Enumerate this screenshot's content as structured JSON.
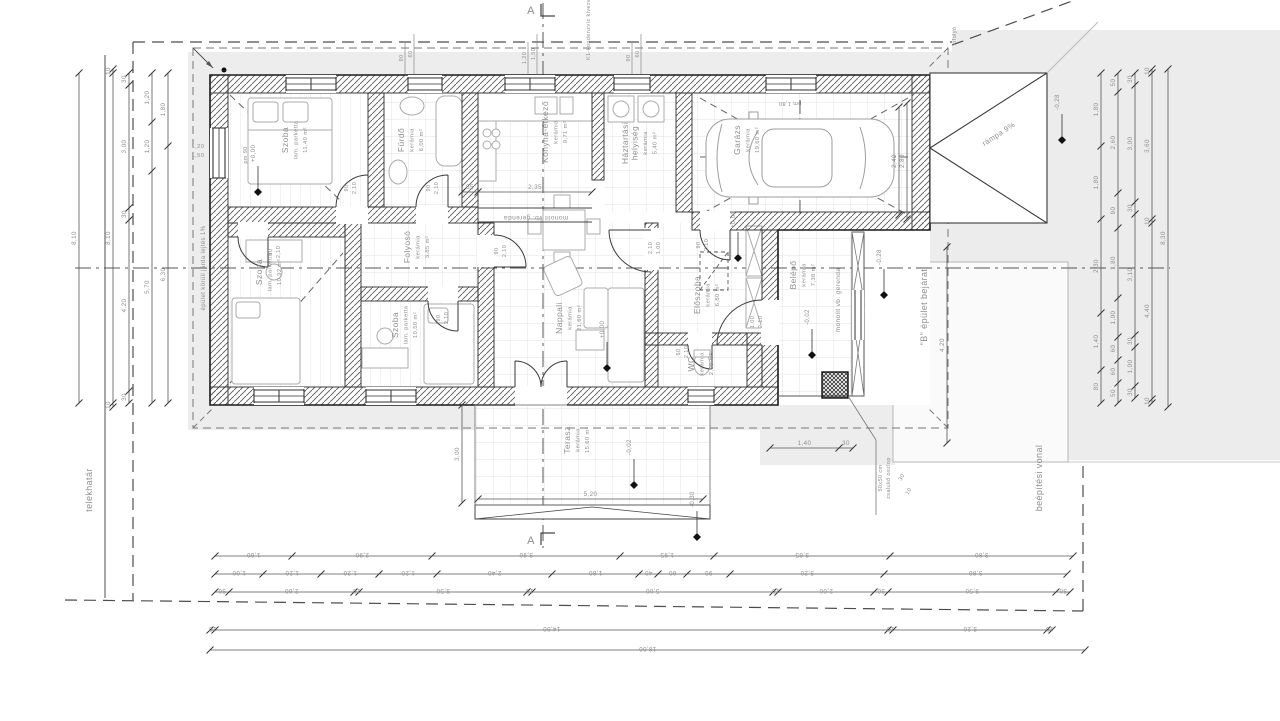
{
  "rooms": [
    {
      "name": "Szoba",
      "finish": "lam. parketta",
      "area": "11,40 m²"
    },
    {
      "name": "Fürdő",
      "finish": "kerámia",
      "area": "6,00 m²"
    },
    {
      "name": "Konyha-étkező",
      "finish": "kerámia",
      "area": "9,71 m²"
    },
    {
      "name": "Háztartási\nhelyiség",
      "finish": "kerámia",
      "area": "5,40 m²"
    },
    {
      "name": "Garázs",
      "finish": "kerámia",
      "area": "19,60 m²"
    },
    {
      "name": "Szoba",
      "finish": "lam. parketta",
      "area": "10,92 m²"
    },
    {
      "name": "Folyosó",
      "finish": "kerámia",
      "area": "3,85 m²"
    },
    {
      "name": "Szoba",
      "finish": "lam. parketta",
      "area": "10,50 m²"
    },
    {
      "name": "Nappali",
      "finish": "kerámia",
      "area": "21,60 m²"
    },
    {
      "name": "Előszoba",
      "finish": "kerámia",
      "area": "6,80 m²"
    },
    {
      "name": "WC",
      "finish": "kerámia",
      "area": "2,00 m²"
    },
    {
      "name": "Belépő",
      "finish": "kerámia",
      "area": "7,38 m²"
    },
    {
      "name": "Terasz",
      "finish": "kerámia",
      "area": "15,60 m²"
    }
  ],
  "annotations": {
    "telekhatar": "telekhatár",
    "beepitesi": "beépítési vonal",
    "jarda": "épület körüli járda lejtés 1%",
    "rampa": "rámpa 9%",
    "b_bejarat": "\"B\" épület bejárat",
    "zsaluko": "50x50 cm\nzsalukő oszlop",
    "gerenda1": "monolit vb. gerenda",
    "gerenda2": "monolit vb. gerenda",
    "kondenz": "K1-kondenzvíz kivezetés",
    "kifolyo": "kifolyó",
    "section_a": "A",
    "pm90": "pm 90",
    "pm180": "pm 1,80"
  },
  "levels": {
    "l1": "+0,00",
    "l2": "+0,00",
    "l3": "+0,00",
    "l4": "-0,02",
    "l5": "-0,02",
    "l6": "-0,28",
    "l7": "-0,28",
    "l8": "-0,30"
  },
  "dims": {
    "left": [
      [
        "8,10"
      ],
      [
        "10",
        "8,10",
        "10"
      ],
      [
        "30",
        "3,00",
        "30",
        "4,20",
        "30"
      ],
      [
        "1,20",
        "1,20",
        "5,70"
      ],
      [
        "1,80",
        "6,30"
      ]
    ],
    "right": [
      [
        "1,80",
        "1,80",
        "2,30",
        "1,40",
        "80"
      ],
      [
        "50",
        "2,60",
        "90",
        "1,80",
        "1,00",
        "60",
        "60",
        "50"
      ],
      [
        "30",
        "3,00",
        "30",
        "3,10",
        "30",
        "1,00",
        "30"
      ],
      [
        "10",
        "3,60",
        "10",
        "4,40",
        "10"
      ],
      [
        "8,30"
      ]
    ],
    "bottom": [
      [
        "1,60",
        "2,90",
        "3,90",
        "1,95",
        "3,65",
        "3,80"
      ],
      [
        "1,00",
        "1,20",
        "1,20",
        "1,20",
        "2,40",
        "1,80",
        "40",
        "60",
        "90",
        "3,20",
        "3,80"
      ],
      [
        "30",
        "2,60",
        "10",
        "3,50",
        "10",
        "5,00",
        "10",
        "2,00",
        "30",
        "3,50",
        "30"
      ],
      [
        "10",
        "14,00",
        "10",
        "3,20",
        "10"
      ],
      [
        "18,00"
      ]
    ],
    "top": {
      "w1": [
        "1,20",
        "1,50"
      ],
      "w2": [
        "90",
        "60"
      ],
      "w3": [
        "1,20",
        "1,50"
      ],
      "w4": [
        "90",
        "60"
      ]
    },
    "doors": [
      "90",
      "2,10",
      "1,00",
      "60"
    ],
    "gate1": [
      "2,40"
    ],
    "gate2": [
      "2,80"
    ],
    "terasz_v": [
      "3,00"
    ],
    "terasz_h": [
      "5,20"
    ],
    "konyha": [
      "55",
      "2,35"
    ],
    "bejarat": [
      "4,20"
    ],
    "porch": [
      "1,40",
      "30"
    ],
    "b_small": [
      "30",
      "10"
    ]
  }
}
